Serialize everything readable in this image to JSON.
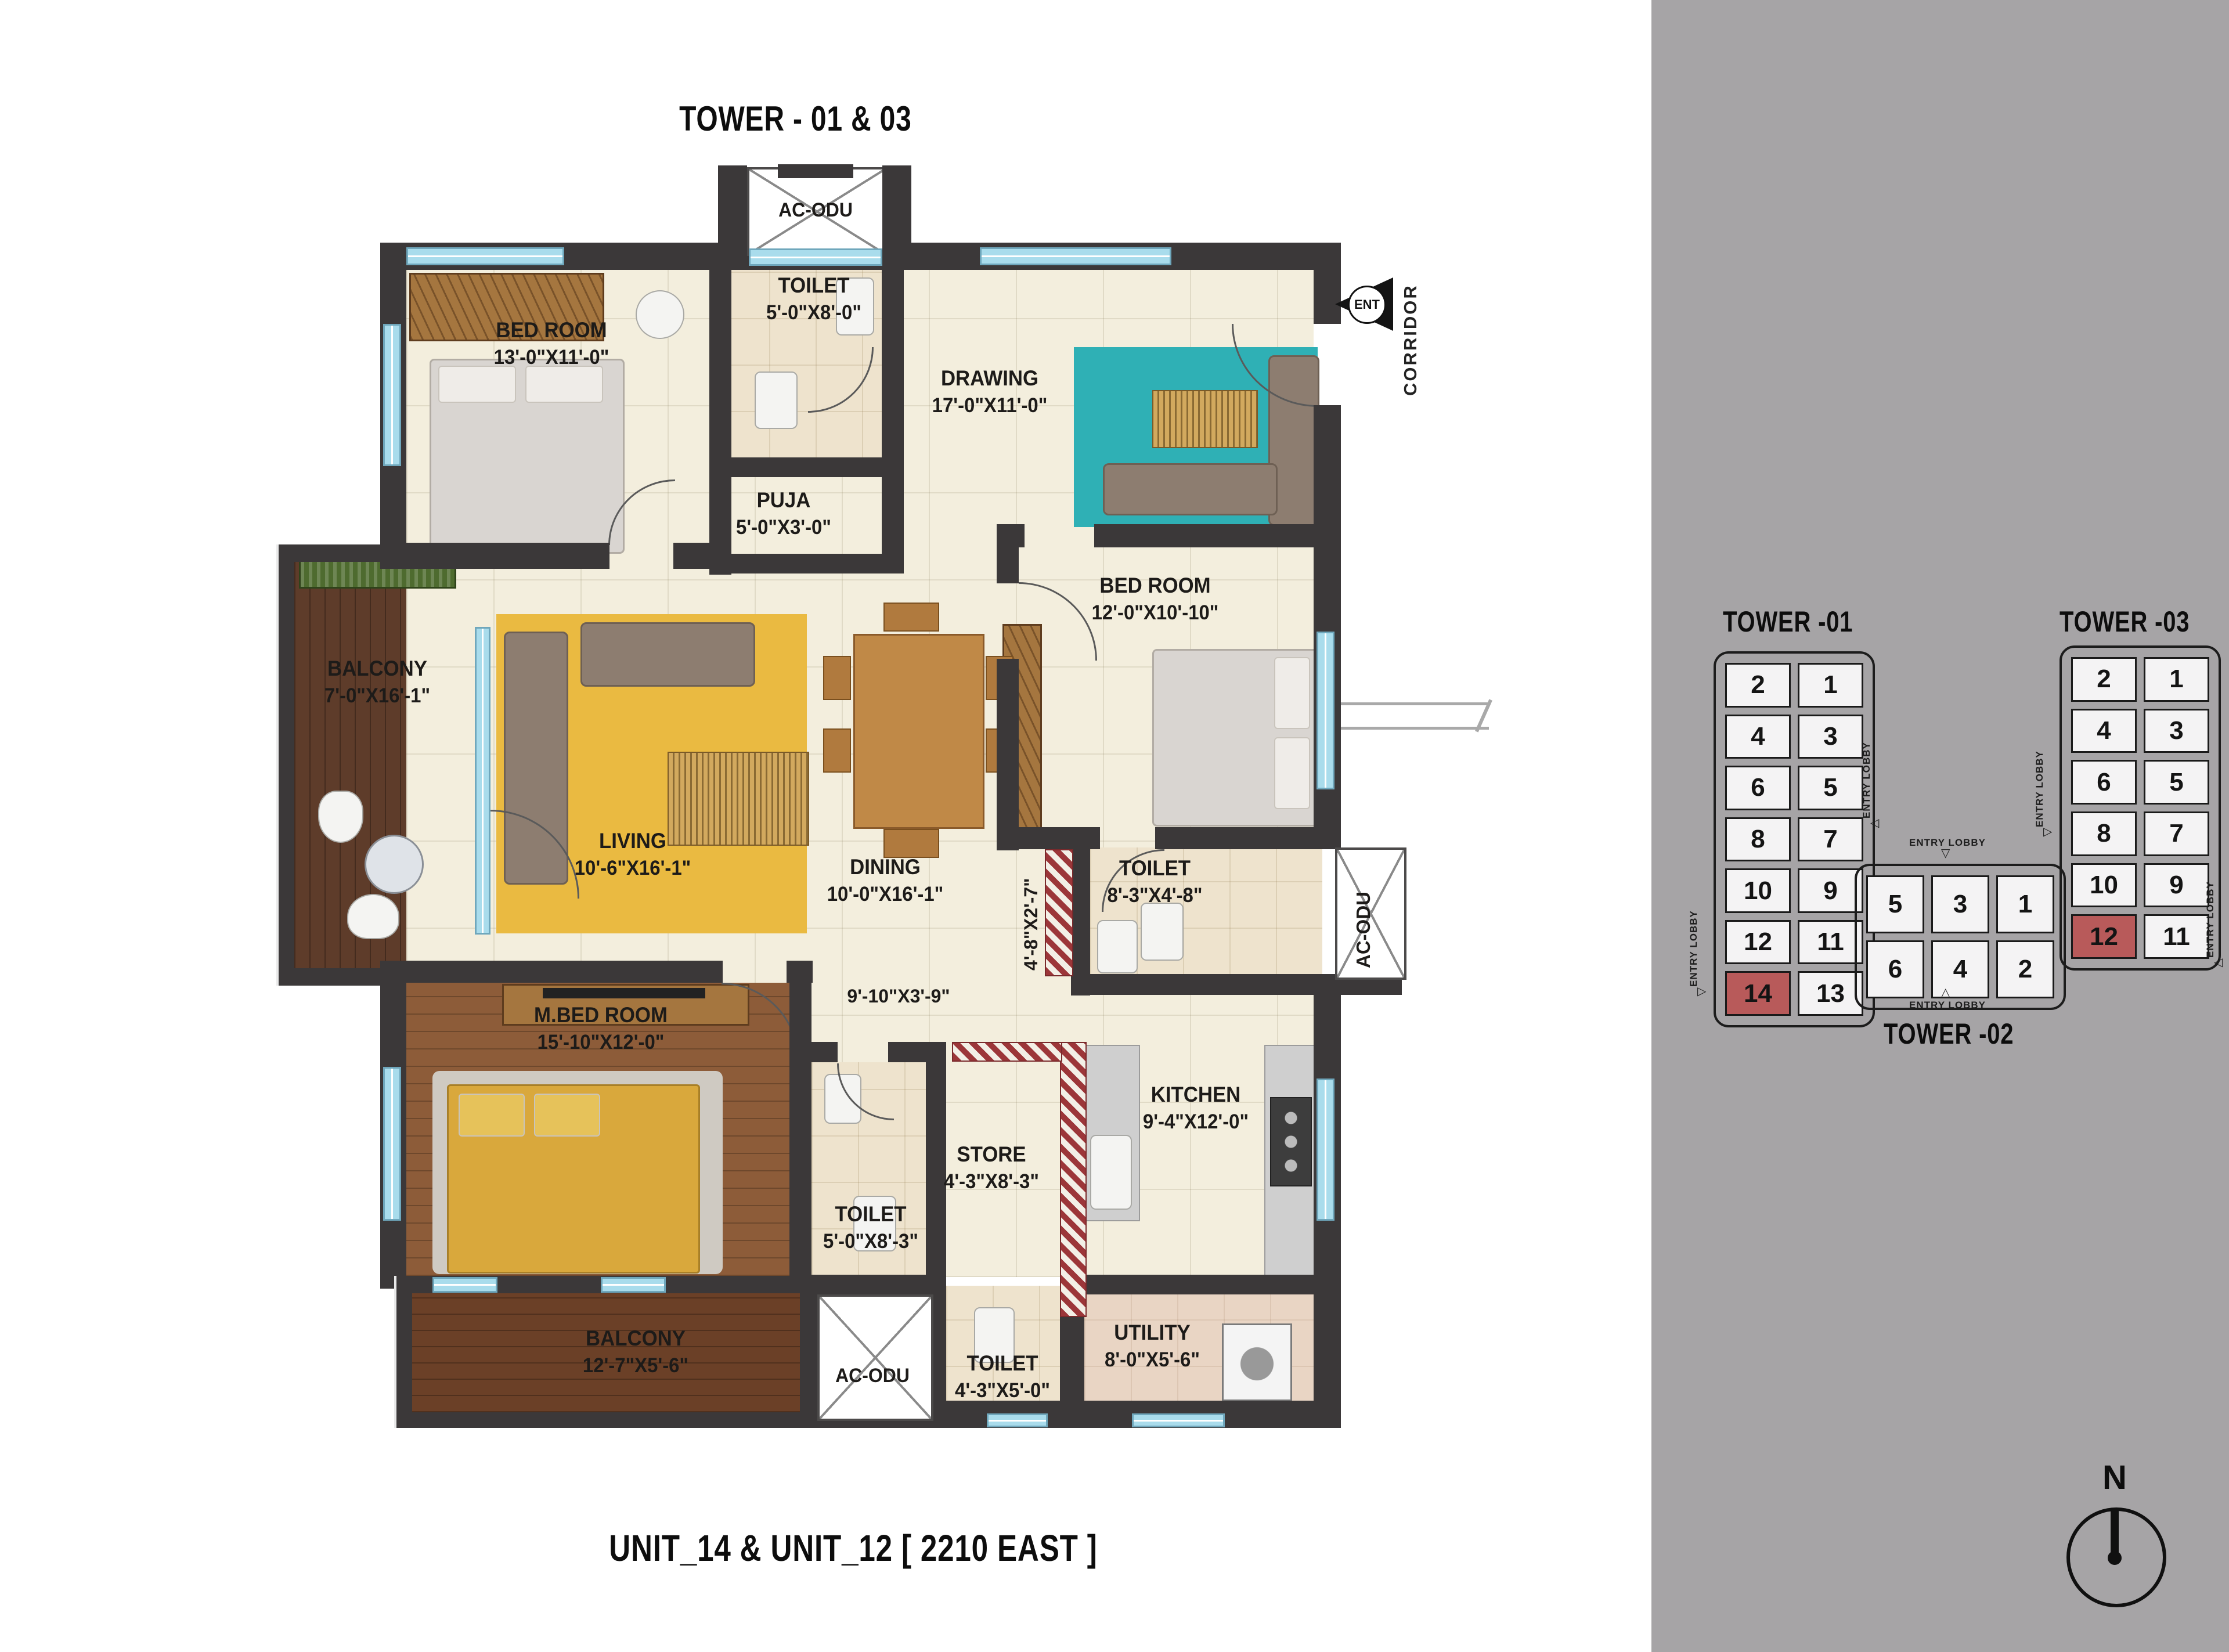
{
  "titles": {
    "top": "TOWER - 01 & 03",
    "bottom": "UNIT_14 & UNIT_12  [ 2210 EAST ]"
  },
  "plan": {
    "rooms": [
      {
        "id": "bedroom-1",
        "name": "BED ROOM",
        "dims": "13'-0\"X11'-0\""
      },
      {
        "id": "toilet-1",
        "name": "TOILET",
        "dims": "5'-0\"X8'-0\""
      },
      {
        "id": "drawing",
        "name": "DRAWING",
        "dims": "17'-0\"X11'-0\""
      },
      {
        "id": "puja",
        "name": "PUJA",
        "dims": "5'-0\"X3'-0\""
      },
      {
        "id": "bedroom-2",
        "name": "BED ROOM",
        "dims": "12'-0\"X10'-10\""
      },
      {
        "id": "balcony-1",
        "name": "BALCONY",
        "dims": "7'-0\"X16'-1\""
      },
      {
        "id": "living",
        "name": "LIVING",
        "dims": "10'-6\"X16'-1\""
      },
      {
        "id": "dining",
        "name": "DINING",
        "dims": "10'-0\"X16'-1\""
      },
      {
        "id": "toilet-2",
        "name": "TOILET",
        "dims": "8'-3\"X4'-8\""
      },
      {
        "id": "m-bedroom",
        "name": "M.BED ROOM",
        "dims": "15'-10\"X12'-0\""
      },
      {
        "id": "store",
        "name": "STORE",
        "dims": "4'-3\"X8'-3\""
      },
      {
        "id": "kitchen",
        "name": "KITCHEN",
        "dims": "9'-4\"X12'-0\""
      },
      {
        "id": "toilet-3",
        "name": "TOILET",
        "dims": "5'-0\"X8'-3\""
      },
      {
        "id": "balcony-2",
        "name": "BALCONY",
        "dims": "12'-7\"X5'-6\""
      },
      {
        "id": "toilet-4",
        "name": "TOILET",
        "dims": "4'-3\"X5'-0\""
      },
      {
        "id": "utility",
        "name": "UTILITY",
        "dims": "8'-0\"X5'-6\""
      }
    ],
    "passages": [
      {
        "text": "4'-8\"X2'-7\"",
        "orientation": "vertical"
      },
      {
        "text": "9'-10\"X3'-9\"",
        "orientation": "horizontal"
      }
    ],
    "ac_odu_label": "AC-ODU",
    "corridor_label": "CORRIDOR",
    "ent_label": "ENT"
  },
  "towers": [
    {
      "id": "tower01",
      "title": "TOWER -01",
      "cols": 2,
      "units": [
        2,
        1,
        4,
        3,
        6,
        5,
        8,
        7,
        10,
        9,
        12,
        11,
        14,
        13
      ],
      "highlighted": [
        14
      ]
    },
    {
      "id": "tower03",
      "title": "TOWER -03",
      "cols": 2,
      "units": [
        2,
        1,
        4,
        3,
        6,
        5,
        8,
        7,
        10,
        9,
        12,
        11
      ],
      "highlighted": [
        12
      ]
    },
    {
      "id": "tower02",
      "title": "TOWER -02",
      "cols": 3,
      "units": [
        5,
        3,
        1,
        6,
        4,
        2
      ],
      "highlighted": []
    }
  ],
  "entry_lobby_label": "ENTRY LOBBY",
  "compass": {
    "label": "N"
  },
  "colors": {
    "wall": "#3b3839",
    "panel": "#a6a4a6",
    "floor": "#f3eedd",
    "window": "#a9dcec",
    "teal_rug": "#2fb0b5",
    "yellow_rug": "#eaba41",
    "stripe_red": "#9c3639",
    "unit_highlight": "#b85a5a",
    "wood_dark": "#5e3c2a",
    "wood_mid": "#8d5c39"
  }
}
